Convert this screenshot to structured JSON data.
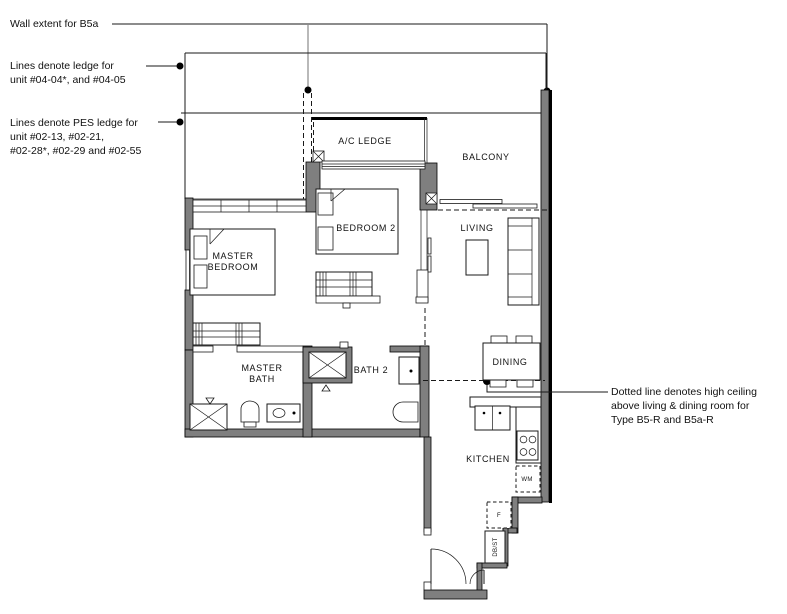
{
  "colors": {
    "wall": "#7f7f7f",
    "line": "#1a1a1a",
    "background": "#ffffff"
  },
  "annotations": {
    "wall_extent": {
      "lines": [
        "Wall extent for B5a"
      ]
    },
    "ledge": {
      "lines": [
        "Lines denote ledge for",
        "unit #04-04*, and #04-05"
      ]
    },
    "pes_ledge": {
      "lines": [
        "Lines denote PES ledge for",
        "unit  #02-13, #02-21,",
        "#02-28*, #02-29 and #02-55"
      ]
    },
    "high_ceiling": {
      "lines": [
        "Dotted line denotes high ceiling",
        "above living & dining room for",
        "Type B5-R and B5a-R"
      ]
    }
  },
  "rooms": {
    "ac_ledge": "A/C LEDGE",
    "balcony": "BALCONY",
    "living": "LIVING",
    "dining": "DINING",
    "kitchen": "KITCHEN",
    "bedroom2": "BEDROOM 2",
    "master_bedroom": [
      "MASTER",
      "BEDROOM"
    ],
    "master_bath": [
      "MASTER",
      "BATH"
    ],
    "bath2": "BATH 2"
  },
  "appliances": {
    "washing_machine": "WM",
    "fridge": "F",
    "db_store": "DB/ST"
  }
}
